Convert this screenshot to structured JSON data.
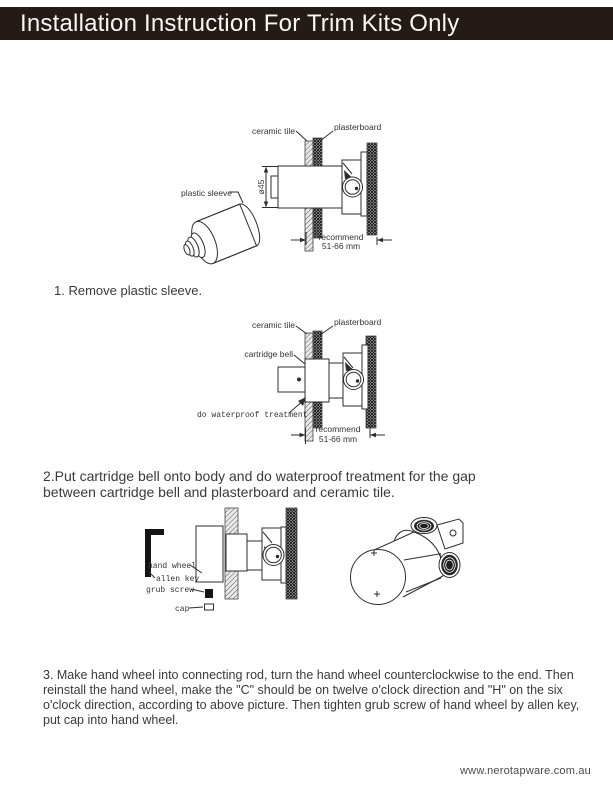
{
  "colors": {
    "header_bg": "#241b17",
    "header_text": "#f7f7f5",
    "body_text": "#3a3a3a",
    "line": "#2e2e2e"
  },
  "header": {
    "title": "Installation Instruction For Trim Kits Only"
  },
  "diagram1": {
    "labels": {
      "plastic_sleeve": "plastic sleeve",
      "ceramic_tile": "ceramic tile",
      "plasterboard": "plasterboard",
      "diameter": "ø45",
      "recommend_line1": "recommend",
      "recommend_line2": "51-66 mm"
    }
  },
  "diagram2": {
    "labels": {
      "ceramic_tile": "ceramic tile",
      "plasterboard": "plasterboard",
      "cartridge_bell": "cartridge bell",
      "waterproof_note": "do waterproof treatment",
      "recommend_line1": "recommend",
      "recommend_line2": "51-66 mm"
    }
  },
  "diagram3": {
    "labels": {
      "hand_wheel": "hand wheel",
      "allen_key": "allen key",
      "grub_screw": "grub screw",
      "cap": "cap"
    }
  },
  "steps": [
    {
      "text": "1. Remove plastic sleeve."
    },
    {
      "text": "2.Put cartridge bell onto body and do waterproof treatment for the gap between cartridge bell and plasterboard and ceramic tile."
    },
    {
      "text": "3. Make hand wheel into connecting rod, turn the hand wheel counterclockwise to the end. Then reinstall the hand wheel, make the \"C\" should be on twelve o'clock direction and \"H\" on the six o'clock direction, according to above picture. Then tighten grub screw of hand wheel by allen key, put cap into hand wheel."
    }
  ],
  "footer": {
    "website": "www.nerotapware.com.au"
  }
}
